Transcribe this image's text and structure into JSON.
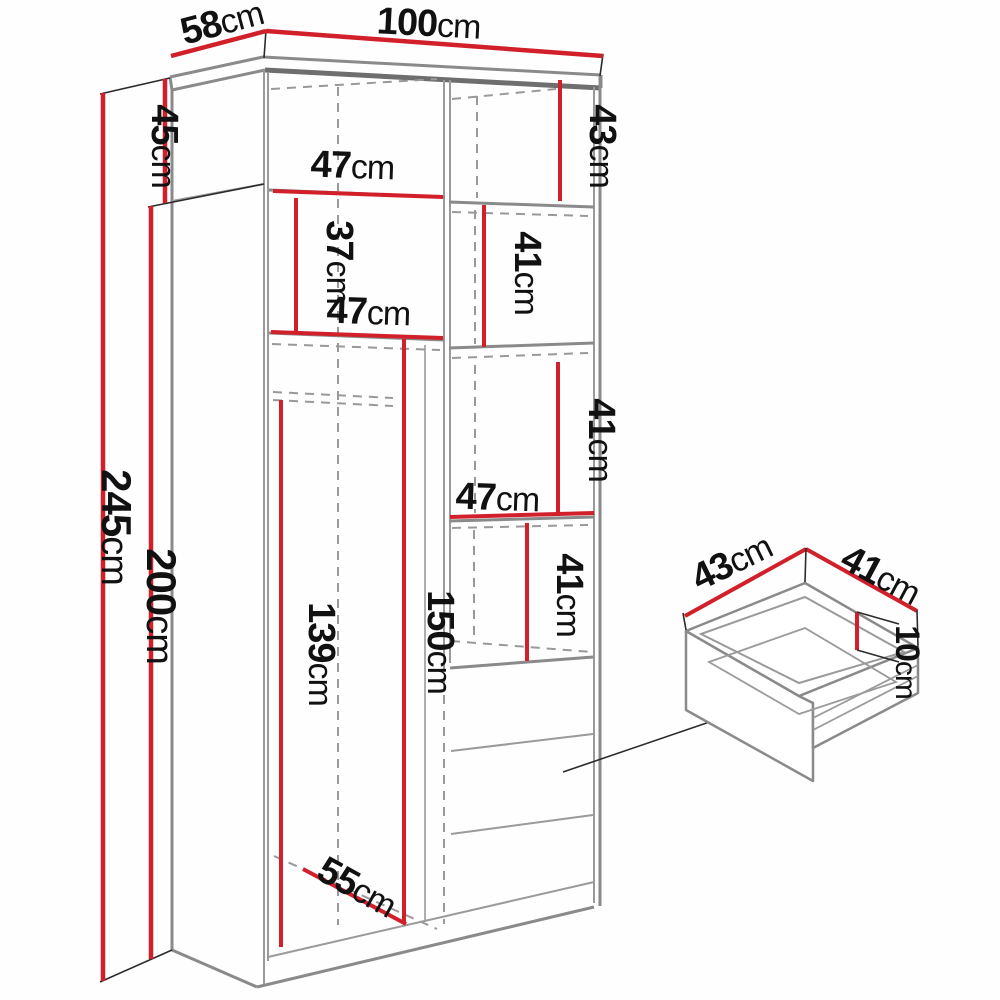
{
  "title": "Wardrobe dimensions diagram",
  "colors": {
    "dimension_red": "#d2202a",
    "cabinet_edge_gray": "#8a8a8a",
    "dashed_gray": "#999999",
    "label_black": "#111111",
    "background": "#ffffff"
  },
  "wardrobe": {
    "depth": {
      "value": "58",
      "unit": "cm"
    },
    "width": {
      "value": "100",
      "unit": "cm"
    },
    "top_section_height": {
      "value": "45",
      "unit": "cm"
    },
    "total_height": {
      "value": "245",
      "unit": "cm"
    },
    "body_height": {
      "value": "200",
      "unit": "cm"
    },
    "top_shelf_height_right": {
      "value": "43",
      "unit": "cm"
    },
    "top_compartment_width_left": {
      "value": "47",
      "unit": "cm"
    },
    "left_shelf_gap": {
      "value": "37",
      "unit": "cm"
    },
    "left_compartment_width": {
      "value": "47",
      "unit": "cm"
    },
    "right_shelf_height_1": {
      "value": "41",
      "unit": "cm"
    },
    "right_shelf_height_2": {
      "value": "41",
      "unit": "cm"
    },
    "right_compartment_width": {
      "value": "47",
      "unit": "cm"
    },
    "right_shelf_height_3": {
      "value": "41",
      "unit": "cm"
    },
    "hanging_section_height": {
      "value": "139",
      "unit": "cm"
    },
    "right_section_height": {
      "value": "150",
      "unit": "cm"
    },
    "floor_depth": {
      "value": "55",
      "unit": "cm"
    }
  },
  "drawer": {
    "depth": {
      "value": "43",
      "unit": "cm"
    },
    "width": {
      "value": "41",
      "unit": "cm"
    },
    "height": {
      "value": "10",
      "unit": "cm"
    }
  }
}
